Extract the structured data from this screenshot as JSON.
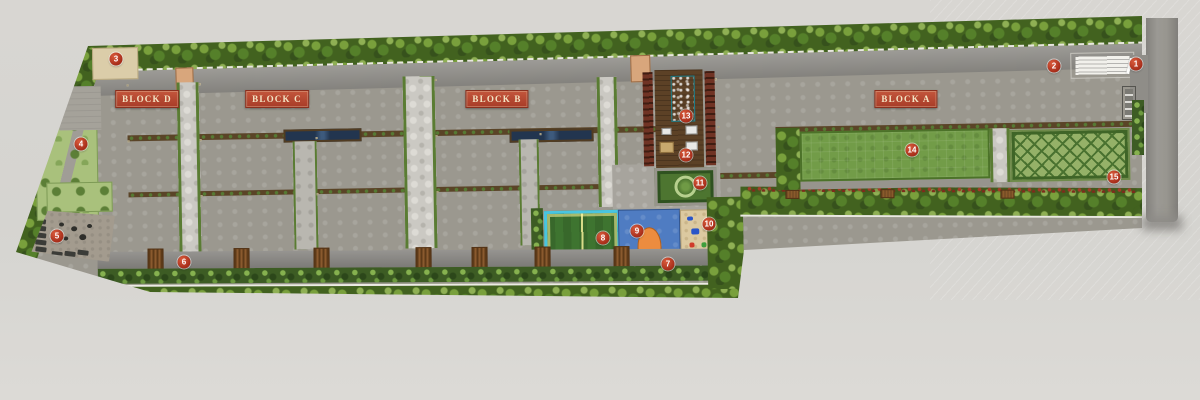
{
  "site_plan": {
    "blocks": [
      {
        "label": "BLOCK D",
        "x": 147,
        "y": 99
      },
      {
        "label": "BLOCK C",
        "x": 277,
        "y": 99
      },
      {
        "label": "BLOCK B",
        "x": 497,
        "y": 99
      },
      {
        "label": "BLOCK A",
        "x": 906,
        "y": 99
      }
    ],
    "markers": [
      {
        "n": "1",
        "x": 1136,
        "y": 64
      },
      {
        "n": "2",
        "x": 1054,
        "y": 66
      },
      {
        "n": "3",
        "x": 116,
        "y": 59
      },
      {
        "n": "4",
        "x": 81,
        "y": 144
      },
      {
        "n": "5",
        "x": 57,
        "y": 236
      },
      {
        "n": "6",
        "x": 184,
        "y": 262
      },
      {
        "n": "7",
        "x": 668,
        "y": 264
      },
      {
        "n": "8",
        "x": 603,
        "y": 238
      },
      {
        "n": "9",
        "x": 637,
        "y": 231
      },
      {
        "n": "10",
        "x": 709,
        "y": 224
      },
      {
        "n": "11",
        "x": 700,
        "y": 183
      },
      {
        "n": "12",
        "x": 686,
        "y": 155
      },
      {
        "n": "13",
        "x": 686,
        "y": 116
      },
      {
        "n": "14",
        "x": 912,
        "y": 150
      },
      {
        "n": "15",
        "x": 1114,
        "y": 177
      }
    ],
    "colors": {
      "marker_red": "#a72d1a",
      "label_bg": "#a83c28",
      "label_text": "#f3e4c4",
      "pool_teal": "#35c2c8",
      "court_blue": "#4f7cc2",
      "court_green": "#3e7430",
      "lawn_green": "#729c48",
      "building_cream": "#ede5cd",
      "road_gray": "#8f8d88",
      "hedge_green": "#42621f",
      "background": "#d7d5d1"
    }
  }
}
